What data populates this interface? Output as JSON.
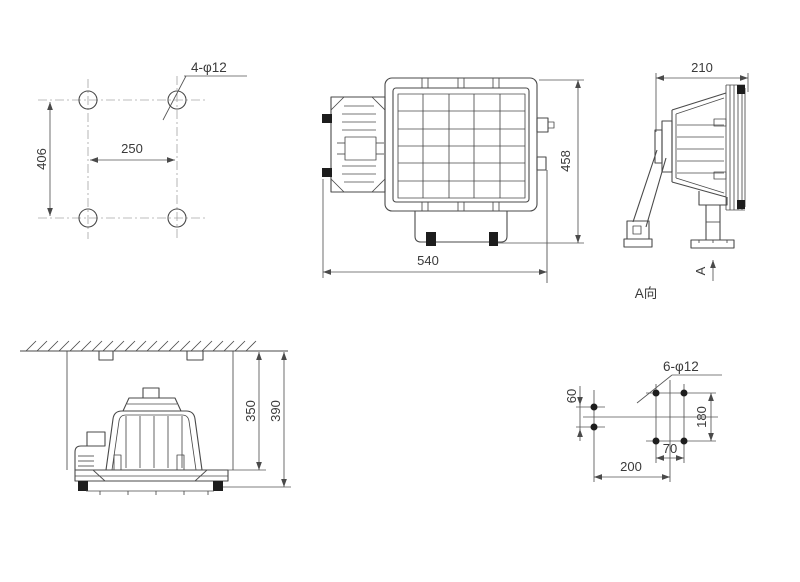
{
  "drawing": {
    "background": "#ffffff",
    "line_color": "#4a4a4a",
    "centerline_color": "#a8a8a8",
    "text_color": "#3a3a3a",
    "views": {
      "top_hole_pattern": {
        "callout": "4-φ12",
        "dim_height": "406",
        "dim_width": "250"
      },
      "front_view": {
        "dim_width": "540",
        "dim_height": "458"
      },
      "side_view": {
        "dim_depth": "210",
        "arrow_label": "A",
        "direction_label": "A向"
      },
      "installation_view": {
        "dim_mount_height": "350",
        "dim_overall_height": "390"
      },
      "bottom_hole_pattern": {
        "callout": "6-φ12",
        "dim_spacing": "60",
        "dim_height": "180",
        "dim_width": "70",
        "dim_offset": "200"
      }
    }
  }
}
